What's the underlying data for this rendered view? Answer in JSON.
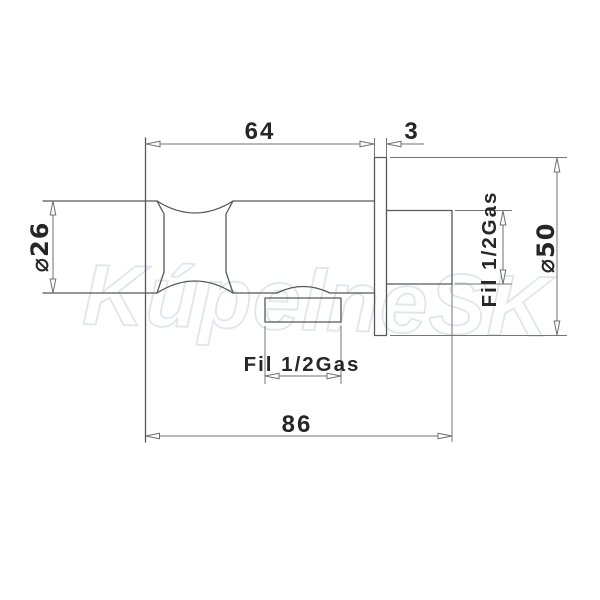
{
  "watermark": {
    "text": "KúpelneSK",
    "color": "#e1e5ee"
  },
  "colors": {
    "background": "#ffffff",
    "part_outline": "#585858",
    "dimension_lines": "#6f6f6f",
    "label_text": "#262626"
  },
  "dimensions": {
    "length_to_wall": {
      "label": "64"
    },
    "flange_thickness": {
      "label": "3"
    },
    "overall_length": {
      "label": "86"
    },
    "body_diameter": {
      "label": "⌀26"
    },
    "flange_diameter": {
      "label": "⌀50"
    },
    "rear_thread": {
      "label": "Fil 1/2Gas"
    },
    "bottom_thread": {
      "label": "Fil 1/2Gas"
    }
  }
}
